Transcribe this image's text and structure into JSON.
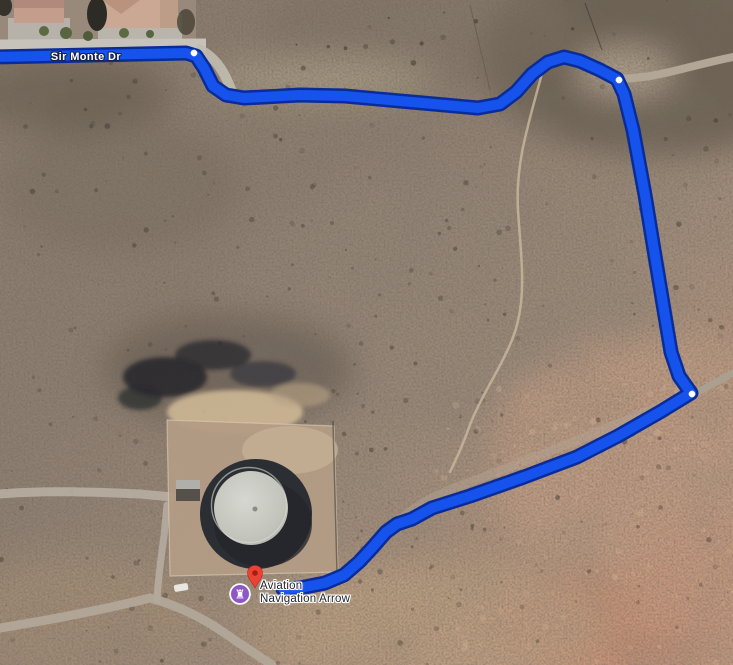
{
  "map": {
    "view": "satellite",
    "road_label": "Sir Monte Dr",
    "road_label_pos": {
      "x": 86,
      "y": 57
    },
    "poi": {
      "name_line1": "Aviation",
      "name_line2": "Navigation Arrow",
      "icon": "monument-rook-icon",
      "icon_glyph": "♜",
      "icon_bg_color": "#8E57C5",
      "icon_ring_color": "#FFFFFF",
      "pin_color": "#EA4335",
      "pin_dark_color": "#8F1007",
      "icon_x": 240,
      "icon_y": 594,
      "pin_x": 255,
      "pin_y": 574
    },
    "route": {
      "color": "#1553EC",
      "border_color": "#0A2C99",
      "width": 10,
      "border_width": 15,
      "points": [
        [
          -8,
          57
        ],
        [
          186,
          53
        ],
        [
          196,
          56
        ],
        [
          204,
          68
        ],
        [
          213,
          86
        ],
        [
          226,
          95
        ],
        [
          244,
          98
        ],
        [
          300,
          95
        ],
        [
          345,
          96
        ],
        [
          400,
          101
        ],
        [
          445,
          105
        ],
        [
          478,
          108
        ],
        [
          500,
          104
        ],
        [
          516,
          92
        ],
        [
          532,
          74
        ],
        [
          548,
          62
        ],
        [
          564,
          57
        ],
        [
          580,
          61
        ],
        [
          600,
          70
        ],
        [
          617,
          79
        ],
        [
          624,
          94
        ],
        [
          633,
          130
        ],
        [
          645,
          195
        ],
        [
          656,
          262
        ],
        [
          666,
          322
        ],
        [
          671,
          352
        ],
        [
          679,
          376
        ],
        [
          691,
          393
        ],
        [
          660,
          412
        ],
        [
          618,
          436
        ],
        [
          577,
          457
        ],
        [
          524,
          477
        ],
        [
          470,
          496
        ],
        [
          432,
          508
        ],
        [
          412,
          519
        ],
        [
          397,
          524
        ],
        [
          386,
          532
        ],
        [
          372,
          548
        ],
        [
          359,
          562
        ],
        [
          344,
          575
        ],
        [
          325,
          583
        ],
        [
          300,
          588
        ],
        [
          283,
          589
        ]
      ],
      "waypoints": [
        [
          194,
          53
        ],
        [
          619,
          80
        ],
        [
          692,
          394
        ]
      ],
      "waypoint_color": "#FFFFFF"
    }
  }
}
